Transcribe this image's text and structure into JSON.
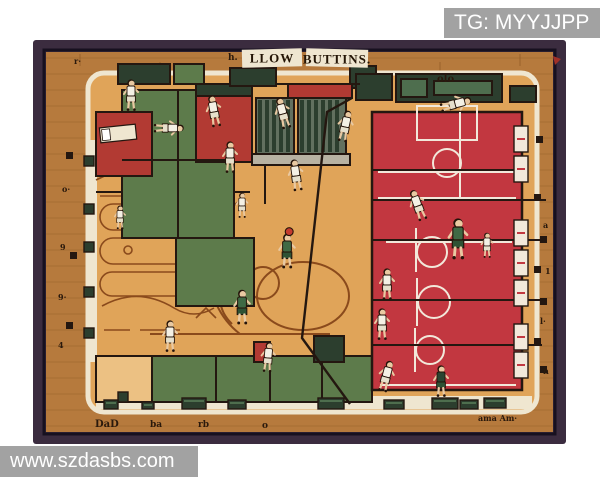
{
  "watermarks": {
    "top": "TG: MYYJJPP",
    "bottom": "www.szdasbs.com"
  },
  "artwork": {
    "title_word1": "LLOW",
    "title_word2": "BUTTINS.",
    "colors": {
      "frame": "#3b2c3f",
      "frame_edge": "#17101f",
      "wood": "#b67a3d",
      "wood_streak": "#8f5a26",
      "floor": "#e0a459",
      "floor_light": "#ecc183",
      "cream": "#efe6d0",
      "red": "#b23a33",
      "court_red": "#c23740",
      "green": "#5d7b4b",
      "green_dark": "#2c3e2e",
      "green_panel": "#4e6e4e",
      "louver": "#62705f",
      "sill": "#b8b2a2",
      "outline": "#241710",
      "line_brown": "#8a4a1c",
      "white_line": "#f2e8da",
      "skin": "#e9c9a2",
      "jersey_white": "#f4f0e4",
      "jersey_green": "#3f6a45",
      "jersey_dark": "#2a4431",
      "shorts_white": "#e6e0cc",
      "shorts_green": "#2e5234",
      "ball": "#c43b2f",
      "hair": "#241309",
      "watermark_bg": "#9c9c9c",
      "watermark_text": "#ffffff"
    },
    "rooms": [
      {
        "x": 122,
        "y": 90,
        "w": 112,
        "h": 148,
        "fill": "green"
      },
      {
        "x": 96,
        "y": 112,
        "w": 56,
        "h": 64,
        "fill": "red"
      },
      {
        "x": 176,
        "y": 238,
        "w": 78,
        "h": 68,
        "fill": "green"
      },
      {
        "x": 196,
        "y": 84,
        "w": 56,
        "h": 12,
        "fill": "green_dark"
      },
      {
        "x": 196,
        "y": 96,
        "w": 56,
        "h": 66,
        "fill": "red"
      },
      {
        "x": 118,
        "y": 64,
        "w": 52,
        "h": 20,
        "fill": "green_dark"
      },
      {
        "x": 174,
        "y": 64,
        "w": 30,
        "h": 20,
        "fill": "green"
      },
      {
        "x": 230,
        "y": 68,
        "w": 46,
        "h": 18,
        "fill": "green_dark"
      },
      {
        "x": 350,
        "y": 66,
        "w": 26,
        "h": 22,
        "fill": "green_dark"
      },
      {
        "x": 288,
        "y": 84,
        "w": 64,
        "h": 14,
        "fill": "red"
      },
      {
        "x": 256,
        "y": 98,
        "w": 38,
        "h": 56,
        "fill": "louver",
        "type": "louver"
      },
      {
        "x": 298,
        "y": 98,
        "w": 48,
        "h": 56,
        "fill": "louver",
        "type": "louver"
      },
      {
        "x": 252,
        "y": 154,
        "w": 98,
        "h": 11,
        "fill": "sill"
      },
      {
        "x": 356,
        "y": 74,
        "w": 36,
        "h": 26,
        "fill": "green_dark"
      },
      {
        "x": 396,
        "y": 74,
        "w": 106,
        "h": 28,
        "fill": "green_dark"
      },
      {
        "x": 401,
        "y": 79,
        "w": 26,
        "h": 18,
        "fill": "green_panel"
      },
      {
        "x": 434,
        "y": 81,
        "w": 58,
        "h": 14,
        "fill": "green_panel"
      },
      {
        "x": 510,
        "y": 86,
        "w": 26,
        "h": 16,
        "fill": "green_dark"
      },
      {
        "x": 96,
        "y": 356,
        "w": 56,
        "h": 46,
        "fill": "floor_light"
      },
      {
        "x": 152,
        "y": 356,
        "w": 172,
        "h": 46,
        "fill": "green"
      },
      {
        "x": 322,
        "y": 356,
        "w": 50,
        "h": 46,
        "fill": "green"
      },
      {
        "x": 314,
        "y": 336,
        "w": 30,
        "h": 26,
        "fill": "green_dark"
      },
      {
        "x": 254,
        "y": 342,
        "w": 16,
        "h": 20,
        "fill": "red"
      }
    ],
    "white_markers": [
      {
        "x": 514,
        "y": 126
      },
      {
        "x": 514,
        "y": 156
      },
      {
        "x": 514,
        "y": 220
      },
      {
        "x": 514,
        "y": 250
      },
      {
        "x": 514,
        "y": 280
      },
      {
        "x": 514,
        "y": 324
      },
      {
        "x": 514,
        "y": 352
      }
    ],
    "door_squares": [
      {
        "x": 84,
        "y": 156
      },
      {
        "x": 84,
        "y": 204
      },
      {
        "x": 84,
        "y": 242
      },
      {
        "x": 84,
        "y": 287
      },
      {
        "x": 84,
        "y": 328
      },
      {
        "x": 118,
        "y": 392
      }
    ],
    "tick_squares": [
      {
        "x": 534,
        "y": 194
      },
      {
        "x": 540,
        "y": 236
      },
      {
        "x": 534,
        "y": 266
      },
      {
        "x": 540,
        "y": 298
      },
      {
        "x": 534,
        "y": 338
      },
      {
        "x": 540,
        "y": 366
      },
      {
        "x": 536,
        "y": 136
      },
      {
        "x": 66,
        "y": 152
      },
      {
        "x": 70,
        "y": 252
      },
      {
        "x": 66,
        "y": 322
      }
    ],
    "benches": [
      {
        "x": 104,
        "y": 400,
        "w": 14,
        "h": 9
      },
      {
        "x": 142,
        "y": 402,
        "w": 12,
        "h": 7
      },
      {
        "x": 182,
        "y": 398,
        "w": 24,
        "h": 11
      },
      {
        "x": 228,
        "y": 400,
        "w": 18,
        "h": 9
      },
      {
        "x": 318,
        "y": 398,
        "w": 26,
        "h": 11
      },
      {
        "x": 384,
        "y": 400,
        "w": 20,
        "h": 9
      },
      {
        "x": 432,
        "y": 398,
        "w": 26,
        "h": 11
      },
      {
        "x": 460,
        "y": 400,
        "w": 18,
        "h": 9
      },
      {
        "x": 484,
        "y": 398,
        "w": 22,
        "h": 10
      }
    ],
    "labels": [
      {
        "x": 437,
        "y": 82,
        "t": "olo",
        "s": 10
      },
      {
        "x": 95,
        "y": 427,
        "t": "DaD",
        "s": 10
      },
      {
        "x": 150,
        "y": 427,
        "t": "ba",
        "s": 9
      },
      {
        "x": 198,
        "y": 427,
        "t": "rb",
        "s": 9
      },
      {
        "x": 262,
        "y": 428,
        "t": "o",
        "s": 9
      },
      {
        "x": 478,
        "y": 421,
        "t": "ama Am·",
        "s": 8
      },
      {
        "x": 543,
        "y": 228,
        "t": "a",
        "s": 8
      },
      {
        "x": 545,
        "y": 274,
        "t": "1",
        "s": 8
      },
      {
        "x": 540,
        "y": 324,
        "t": "l·",
        "s": 8
      },
      {
        "x": 543,
        "y": 374,
        "t": "n",
        "s": 8
      },
      {
        "x": 62,
        "y": 192,
        "t": "o·",
        "s": 8
      },
      {
        "x": 60,
        "y": 250,
        "t": "9",
        "s": 8
      },
      {
        "x": 58,
        "y": 300,
        "t": "9·",
        "s": 8
      },
      {
        "x": 58,
        "y": 348,
        "t": "4",
        "s": 8
      },
      {
        "x": 74,
        "y": 64,
        "t": "r·",
        "s": 8
      },
      {
        "x": 228,
        "y": 60,
        "t": "h.",
        "s": 9
      }
    ],
    "players": [
      {
        "x": 131,
        "y": 96,
        "j": "white",
        "r": 0,
        "s": 1
      },
      {
        "x": 214,
        "y": 112,
        "j": "white",
        "r": -10,
        "s": 1
      },
      {
        "x": 283,
        "y": 114,
        "j": "white",
        "r": -15,
        "s": 1
      },
      {
        "x": 345,
        "y": 127,
        "j": "white",
        "r": 12,
        "s": 1
      },
      {
        "x": 455,
        "y": 104,
        "j": "white",
        "r": 75,
        "s": 1
      },
      {
        "x": 168,
        "y": 128,
        "j": "white",
        "r": 90,
        "s": 0.95
      },
      {
        "x": 230,
        "y": 158,
        "j": "white",
        "r": 0,
        "s": 1
      },
      {
        "x": 296,
        "y": 176,
        "j": "white",
        "r": -8,
        "s": 1
      },
      {
        "x": 242,
        "y": 206,
        "j": "white",
        "r": 0,
        "s": 0.8
      },
      {
        "x": 120,
        "y": 218,
        "j": "white",
        "r": 0,
        "s": 0.75
      },
      {
        "x": 418,
        "y": 206,
        "j": "white",
        "r": -20,
        "s": 1
      },
      {
        "x": 458,
        "y": 240,
        "j": "green",
        "r": 0,
        "s": 1.3
      },
      {
        "x": 287,
        "y": 252,
        "j": "green",
        "r": 0,
        "s": 1.1,
        "ball": true
      },
      {
        "x": 387,
        "y": 285,
        "j": "white",
        "r": 0,
        "s": 1
      },
      {
        "x": 242,
        "y": 308,
        "j": "green",
        "r": 0,
        "s": 1.1
      },
      {
        "x": 170,
        "y": 337,
        "j": "white",
        "r": 0,
        "s": 1
      },
      {
        "x": 268,
        "y": 358,
        "j": "white",
        "r": 5,
        "s": 0.95
      },
      {
        "x": 382,
        "y": 325,
        "j": "white",
        "r": 0,
        "s": 1
      },
      {
        "x": 386,
        "y": 377,
        "j": "white",
        "r": 15,
        "s": 1
      },
      {
        "x": 441,
        "y": 382,
        "j": "dark",
        "r": 0,
        "s": 1
      },
      {
        "x": 487,
        "y": 246,
        "j": "white",
        "r": 0,
        "s": 0.8
      }
    ]
  }
}
